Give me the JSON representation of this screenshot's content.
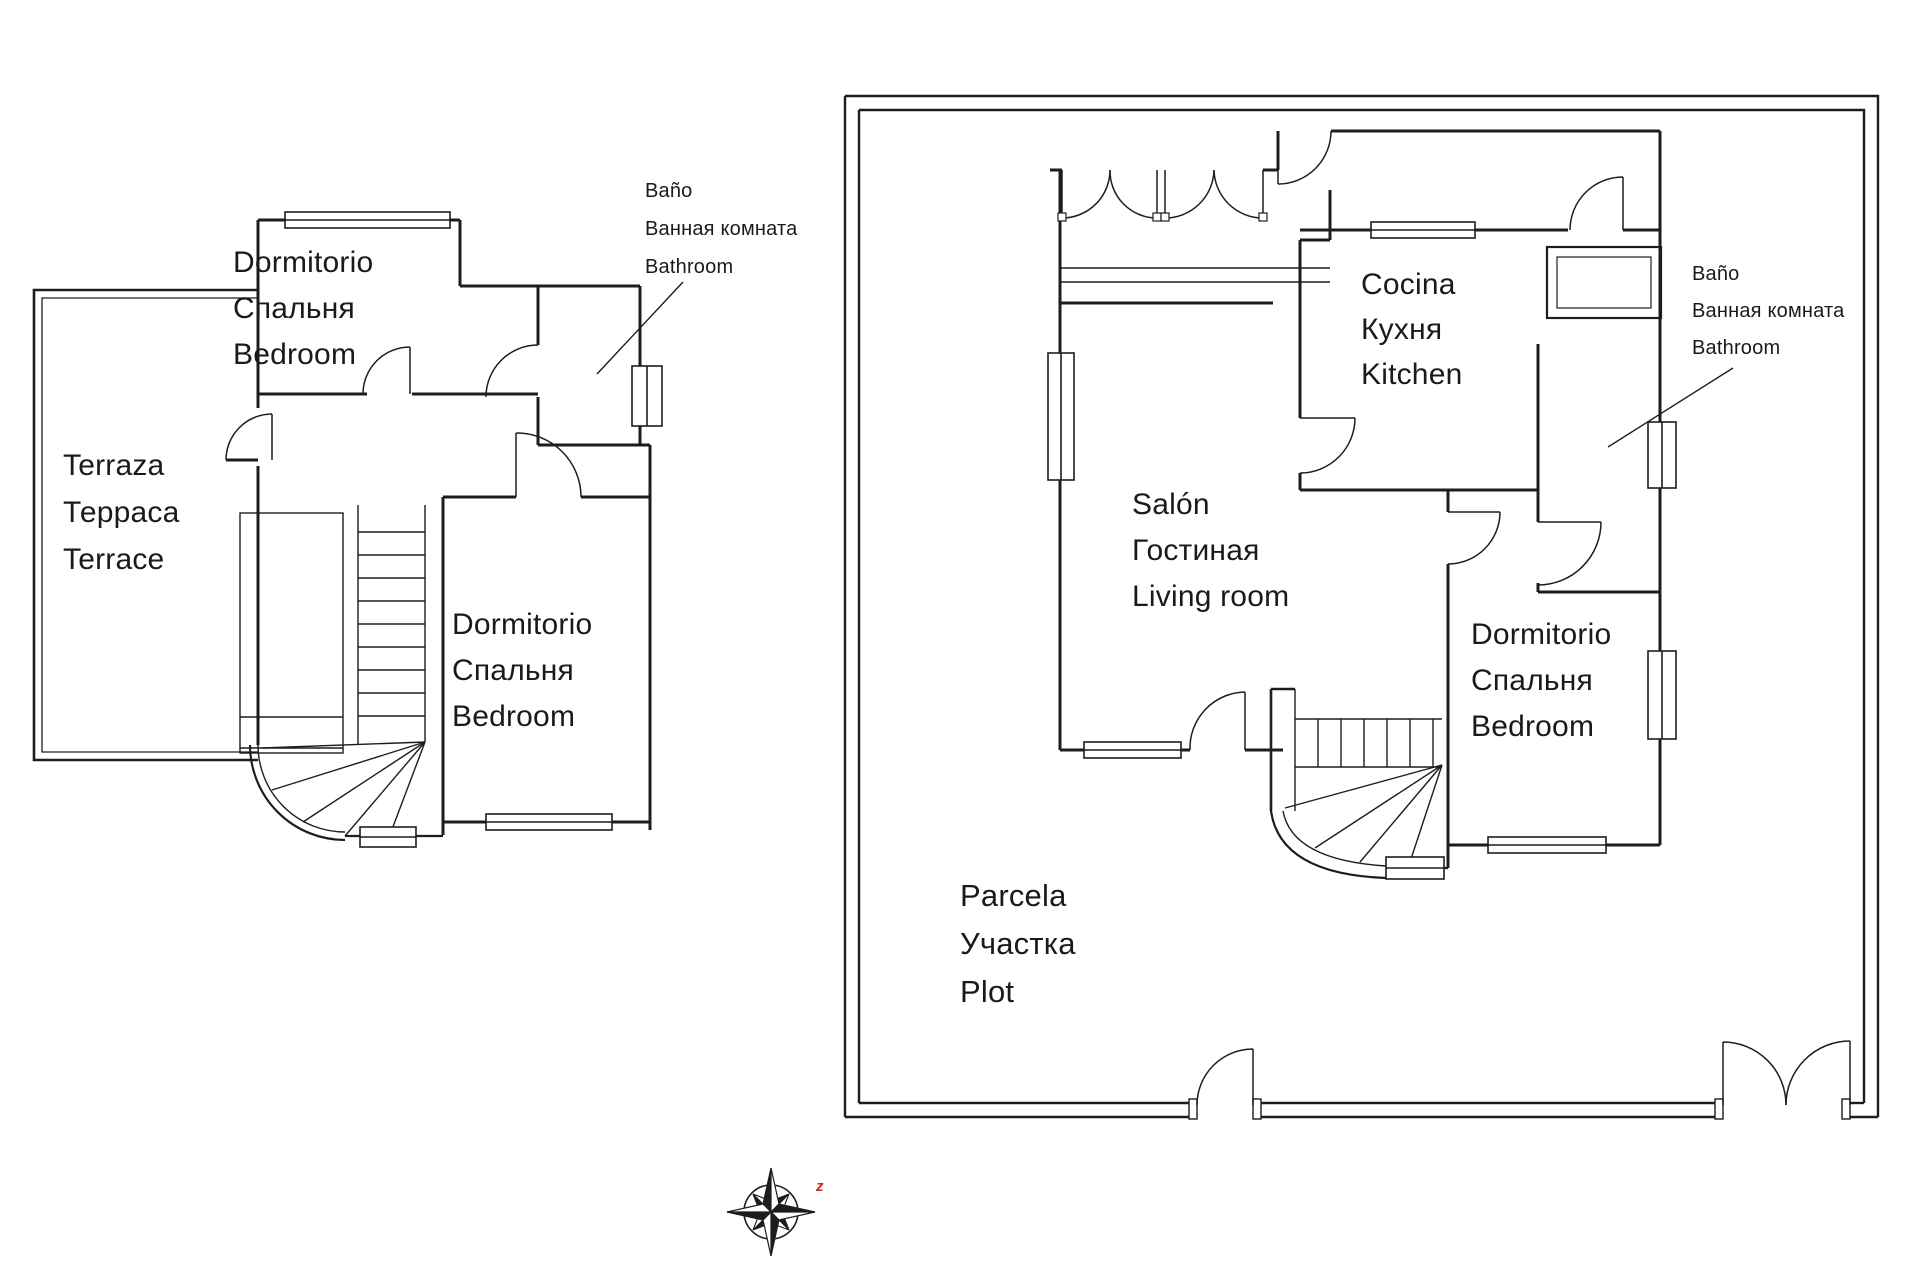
{
  "colors": {
    "line": "#1d1d1d",
    "text": "#1a1a1a",
    "accent_red": "#c22a18",
    "background": "#ffffff"
  },
  "plans": {
    "upper_floor": {
      "bedroom_top": {
        "lines": [
          "Dormitorio",
          "Спальня",
          "Bedroom"
        ]
      },
      "terrace": {
        "lines": [
          "Terraza",
          "Терраса",
          "Terrace"
        ]
      },
      "bedroom_bottom": {
        "lines": [
          "Dormitorio",
          "Спальня",
          "Bedroom"
        ]
      },
      "bathroom_note": {
        "lines": [
          "Baño",
          "Ванная комната",
          "Bathroom"
        ]
      }
    },
    "ground_floor": {
      "kitchen": {
        "lines": [
          "Cocina",
          "Кухня",
          "Kitchen"
        ]
      },
      "living_room": {
        "lines": [
          "Salón",
          "Гостиная",
          "Living room"
        ]
      },
      "bedroom": {
        "lines": [
          "Dormitorio",
          "Спальня",
          "Bedroom"
        ]
      },
      "plot": {
        "lines": [
          "Parcela",
          "Участка",
          "Plot"
        ]
      },
      "bathroom_note": {
        "lines": [
          "Baño",
          "Ванная комната",
          "Bathroom"
        ]
      }
    }
  },
  "compass": {
    "mark": "z"
  }
}
